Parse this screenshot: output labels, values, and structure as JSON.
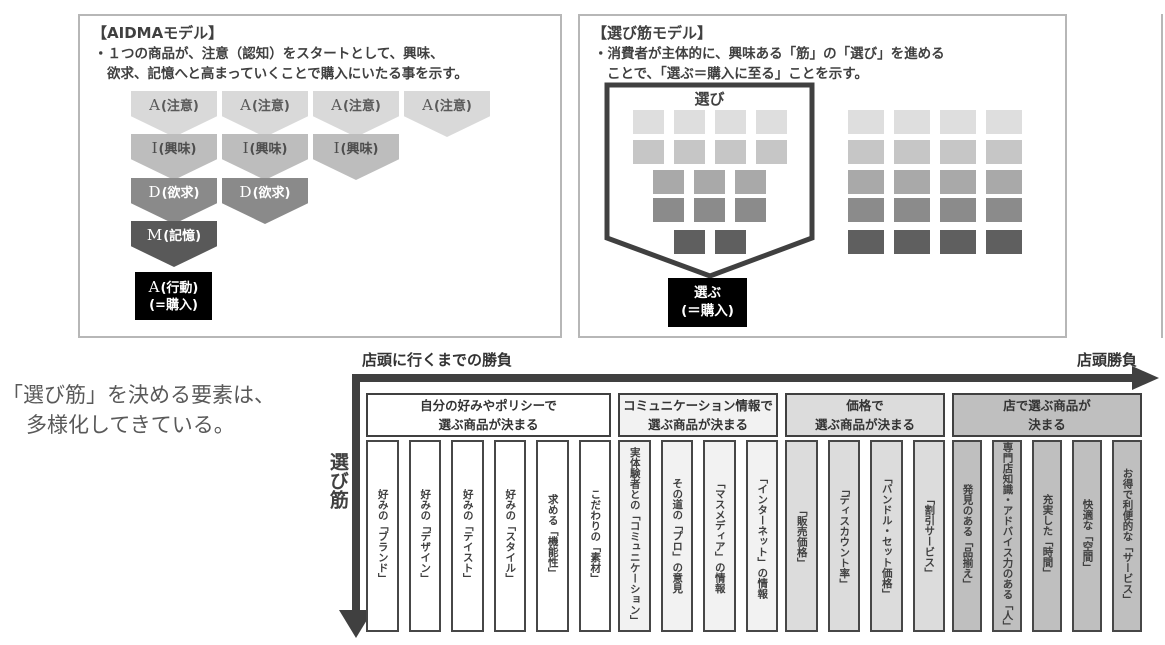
{
  "aidma_panel": {
    "title": "【AIDMAモデル】",
    "description_line1": "・１つの商品が、注意（認知）をスタートとして、興味、",
    "description_line2": "欲求、記憶へと高まっていくことで購入にいたる事を示す。",
    "funnel_rows": [
      {
        "letter": "A",
        "label": "(注意)",
        "count": 4,
        "fill": "#d9d9d9",
        "text_color": "#595959"
      },
      {
        "letter": "I",
        "label": "(興味)",
        "count": 3,
        "fill": "#bdbdbd",
        "text_color": "#4d4d4d"
      },
      {
        "letter": "D",
        "label": "(欲求)",
        "count": 2,
        "fill": "#8a8a8a",
        "text_color": "#ffffff"
      },
      {
        "letter": "M",
        "label": "(記憶)",
        "count": 1,
        "fill": "#595959",
        "text_color": "#ffffff"
      }
    ],
    "action_box": {
      "letter": "A",
      "line1": "(行動)",
      "line2": "(=購入)",
      "bg": "#000000"
    }
  },
  "erabi_panel": {
    "title": "【選び筋モデル】",
    "description_line1": "・消費者が主体的に、興味ある「筋」の「選び」を進める",
    "description_line2": "ことで、「選ぶ＝購入に至る」ことを示す。",
    "funnel_label": "選び",
    "funnel_row_counts": [
      4,
      4,
      3,
      3,
      2
    ],
    "grid_columns": 4,
    "grid_rows": 5,
    "row_colors": [
      "#dedede",
      "#c6c6c6",
      "#a9a9a9",
      "#8b8b8b",
      "#5f5f5f"
    ],
    "outline_color": "#404040",
    "select_box": {
      "line1": "選ぶ",
      "line2": "(＝購入)",
      "bg": "#000000"
    }
  },
  "caption": {
    "line1": "「選び筋」を決める要素は、",
    "line2": "多様化してきている。"
  },
  "bottom_chart": {
    "left_axis_label": "店頭に行くまでの勝負",
    "right_axis_label": "店頭勝負",
    "vertical_axis_label": "選び筋",
    "arrow_color": "#404040",
    "groups": [
      {
        "header_line1": "自分の好みやポリシーで",
        "header_line2": "選ぶ商品が決まる",
        "bg": "#ffffff",
        "items": [
          "好みの「ブランド」",
          "好みの「デザイン」",
          "好みの「テイスト」",
          "好みの「スタイル」",
          "求める「機能性」",
          "こだわりの「素材」"
        ]
      },
      {
        "header_line1": "コミュニケーション情報で",
        "header_line2": "選ぶ商品が決まる",
        "bg": "#f2f2f2",
        "items": [
          "実体験者との「コミュニケーション」",
          "その道の「プロ」の意見",
          "「マスメディア」の情報",
          "「インターネット」の情報"
        ]
      },
      {
        "header_line1": "価格で",
        "header_line2": "選ぶ商品が決まる",
        "bg": "#dcdcdc",
        "items": [
          "「販売価格」",
          "「ディスカウント率」",
          "「バンドル・セット価格」",
          "「割引サービス」"
        ]
      },
      {
        "header_line1": "店で選ぶ商品が",
        "header_line2": "決まる",
        "bg": "#bfbfbf",
        "items": [
          "発見のある「品揃え」",
          "専門店知識・アドバイス力のある「人」",
          "充実した「時間」",
          "快適な「空間」",
          "お得で利便的な「サービス」"
        ]
      }
    ]
  }
}
